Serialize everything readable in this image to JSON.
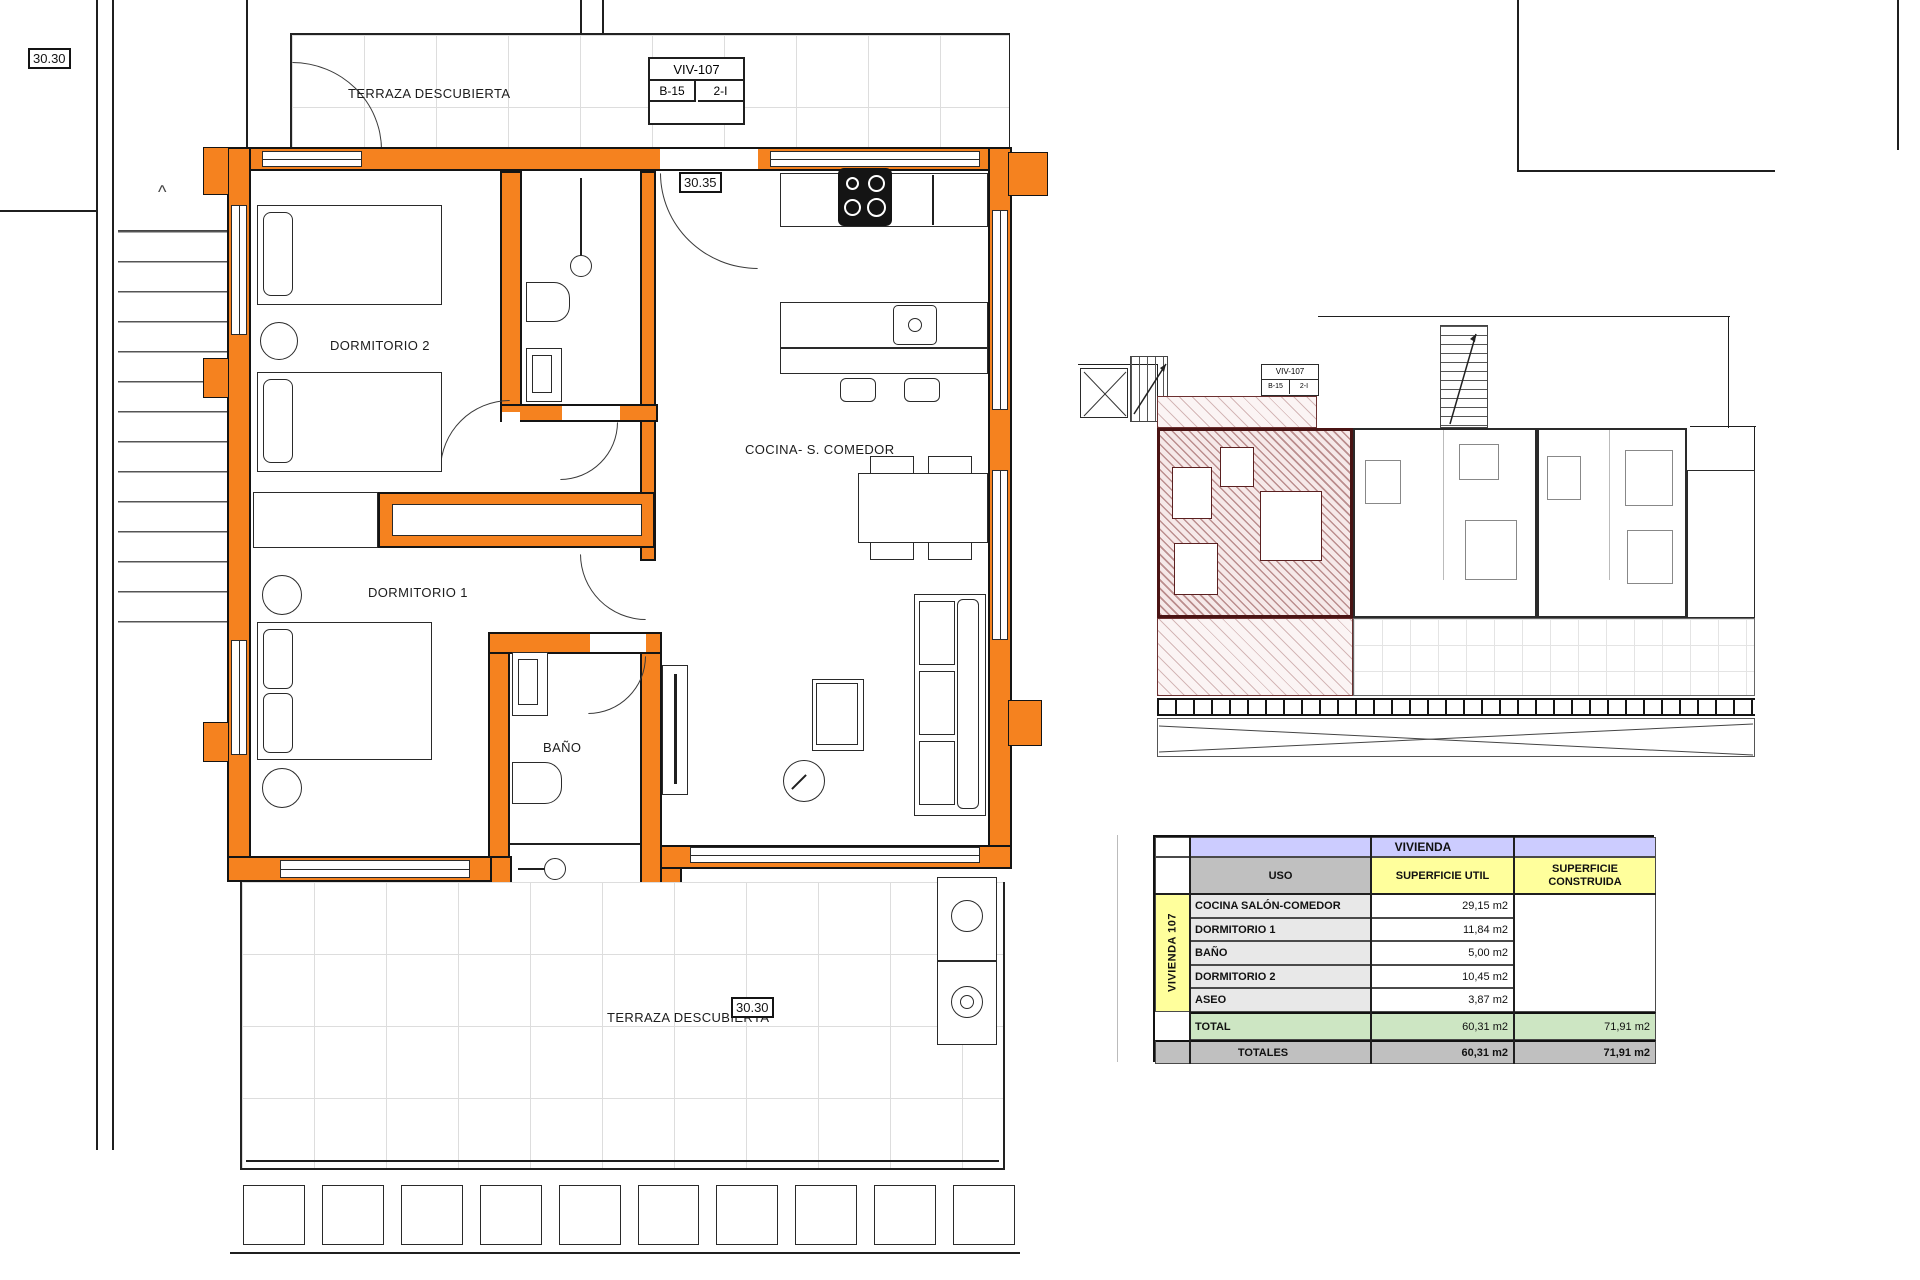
{
  "drawing": {
    "elevation_markers": {
      "top_left": "30.30",
      "interior": "30.35",
      "bottom": "30.30"
    },
    "title_block": {
      "code": "VIV-107",
      "block": "B-15",
      "unit": "2-I"
    },
    "rooms": {
      "terraza_top": "TERRAZA DESCUBIERTA",
      "dormitorio2": "DORMITORIO 2",
      "dormitorio1": "DORMITORIO 1",
      "bano": "BAÑO",
      "cocina": "COCINA- S. COMEDOR",
      "terraza_bottom": "TERRAZA DESCUBIERTA"
    },
    "colors": {
      "wall": "#F5821F",
      "line": "#1f1f1f",
      "hatch": "#803434"
    }
  },
  "overview": {
    "title_block": {
      "code": "VIV-107",
      "block": "B-15",
      "unit": "2-I"
    }
  },
  "table": {
    "title": "VIVIENDA",
    "row_group": "VIVIENDA 107",
    "col_uso": "USO",
    "col_util": "SUPERFICIE UTIL",
    "col_constr_l1": "SUPERFICIE",
    "col_constr_l2": "CONSTRUIDA",
    "rows": [
      {
        "uso": "COCINA SALÓN-COMEDOR",
        "util": "29,15 m2"
      },
      {
        "uso": "DORMITORIO 1",
        "util": "11,84 m2"
      },
      {
        "uso": "BAÑO",
        "util": "5,00 m2"
      },
      {
        "uso": "DORMITORIO 2",
        "util": "10,45 m2"
      },
      {
        "uso": "ASEO",
        "util": "3,87 m2"
      }
    ],
    "total_label": "TOTAL",
    "total_util": "60,31 m2",
    "total_constr": "71,91 m2",
    "totales_label": "TOTALES",
    "totales_util": "60,31 m2",
    "totales_constr": "71,91 m2"
  }
}
